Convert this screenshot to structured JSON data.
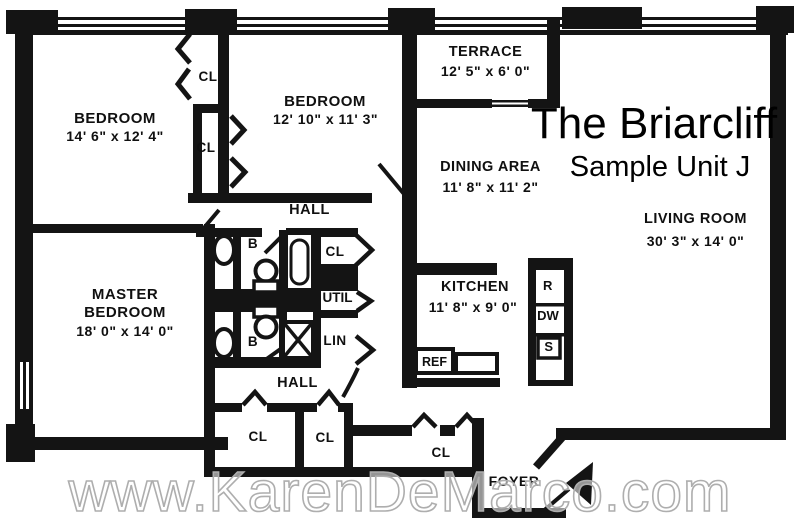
{
  "title": "The Briarcliff",
  "subtitle": "Sample Unit J",
  "watermark": "www.KarenDeMarco.com",
  "colors": {
    "ink": "#141414",
    "paper": "#ffffff",
    "watermark_outline": "#aeaeae"
  },
  "rooms": {
    "bedroom1": {
      "name": "BEDROOM",
      "dims": "14' 6\" x 12' 4\""
    },
    "bedroom2": {
      "name": "BEDROOM",
      "dims": "12' 10\" x 11' 3\""
    },
    "terrace": {
      "name": "TERRACE",
      "dims": "12' 5\" x 6' 0\""
    },
    "dining_area": {
      "name": "DINING AREA",
      "dims": "11' 8\" x 11' 2\""
    },
    "living_room": {
      "name": "LIVING ROOM",
      "dims": "30' 3\" x 14' 0\""
    },
    "master_bedroom": {
      "name_line1": "MASTER",
      "name_line2": "BEDROOM",
      "dims": "18' 0\" x 14' 0\""
    },
    "kitchen": {
      "name": "KITCHEN",
      "dims": "11' 8\" x 9' 0\""
    },
    "foyer": {
      "name": "FOYER"
    },
    "hall_upper": {
      "name": "HALL"
    },
    "hall_lower": {
      "name": "HALL"
    }
  },
  "fixtures": {
    "bath_upper": "B",
    "bath_lower": "B",
    "utility_closet": "UTIL",
    "linen_closet": "LIN",
    "refrigerator": "REF",
    "range": "R",
    "dishwasher": "DW",
    "sink": "S",
    "closets": {
      "bedroom1_closet": "CL",
      "bedroom2_closet": "CL",
      "hall_upper_closet": "CL",
      "hall_lower_closet_1": "CL",
      "hall_lower_closet_2": "CL",
      "foyer_closet": "CL"
    }
  }
}
